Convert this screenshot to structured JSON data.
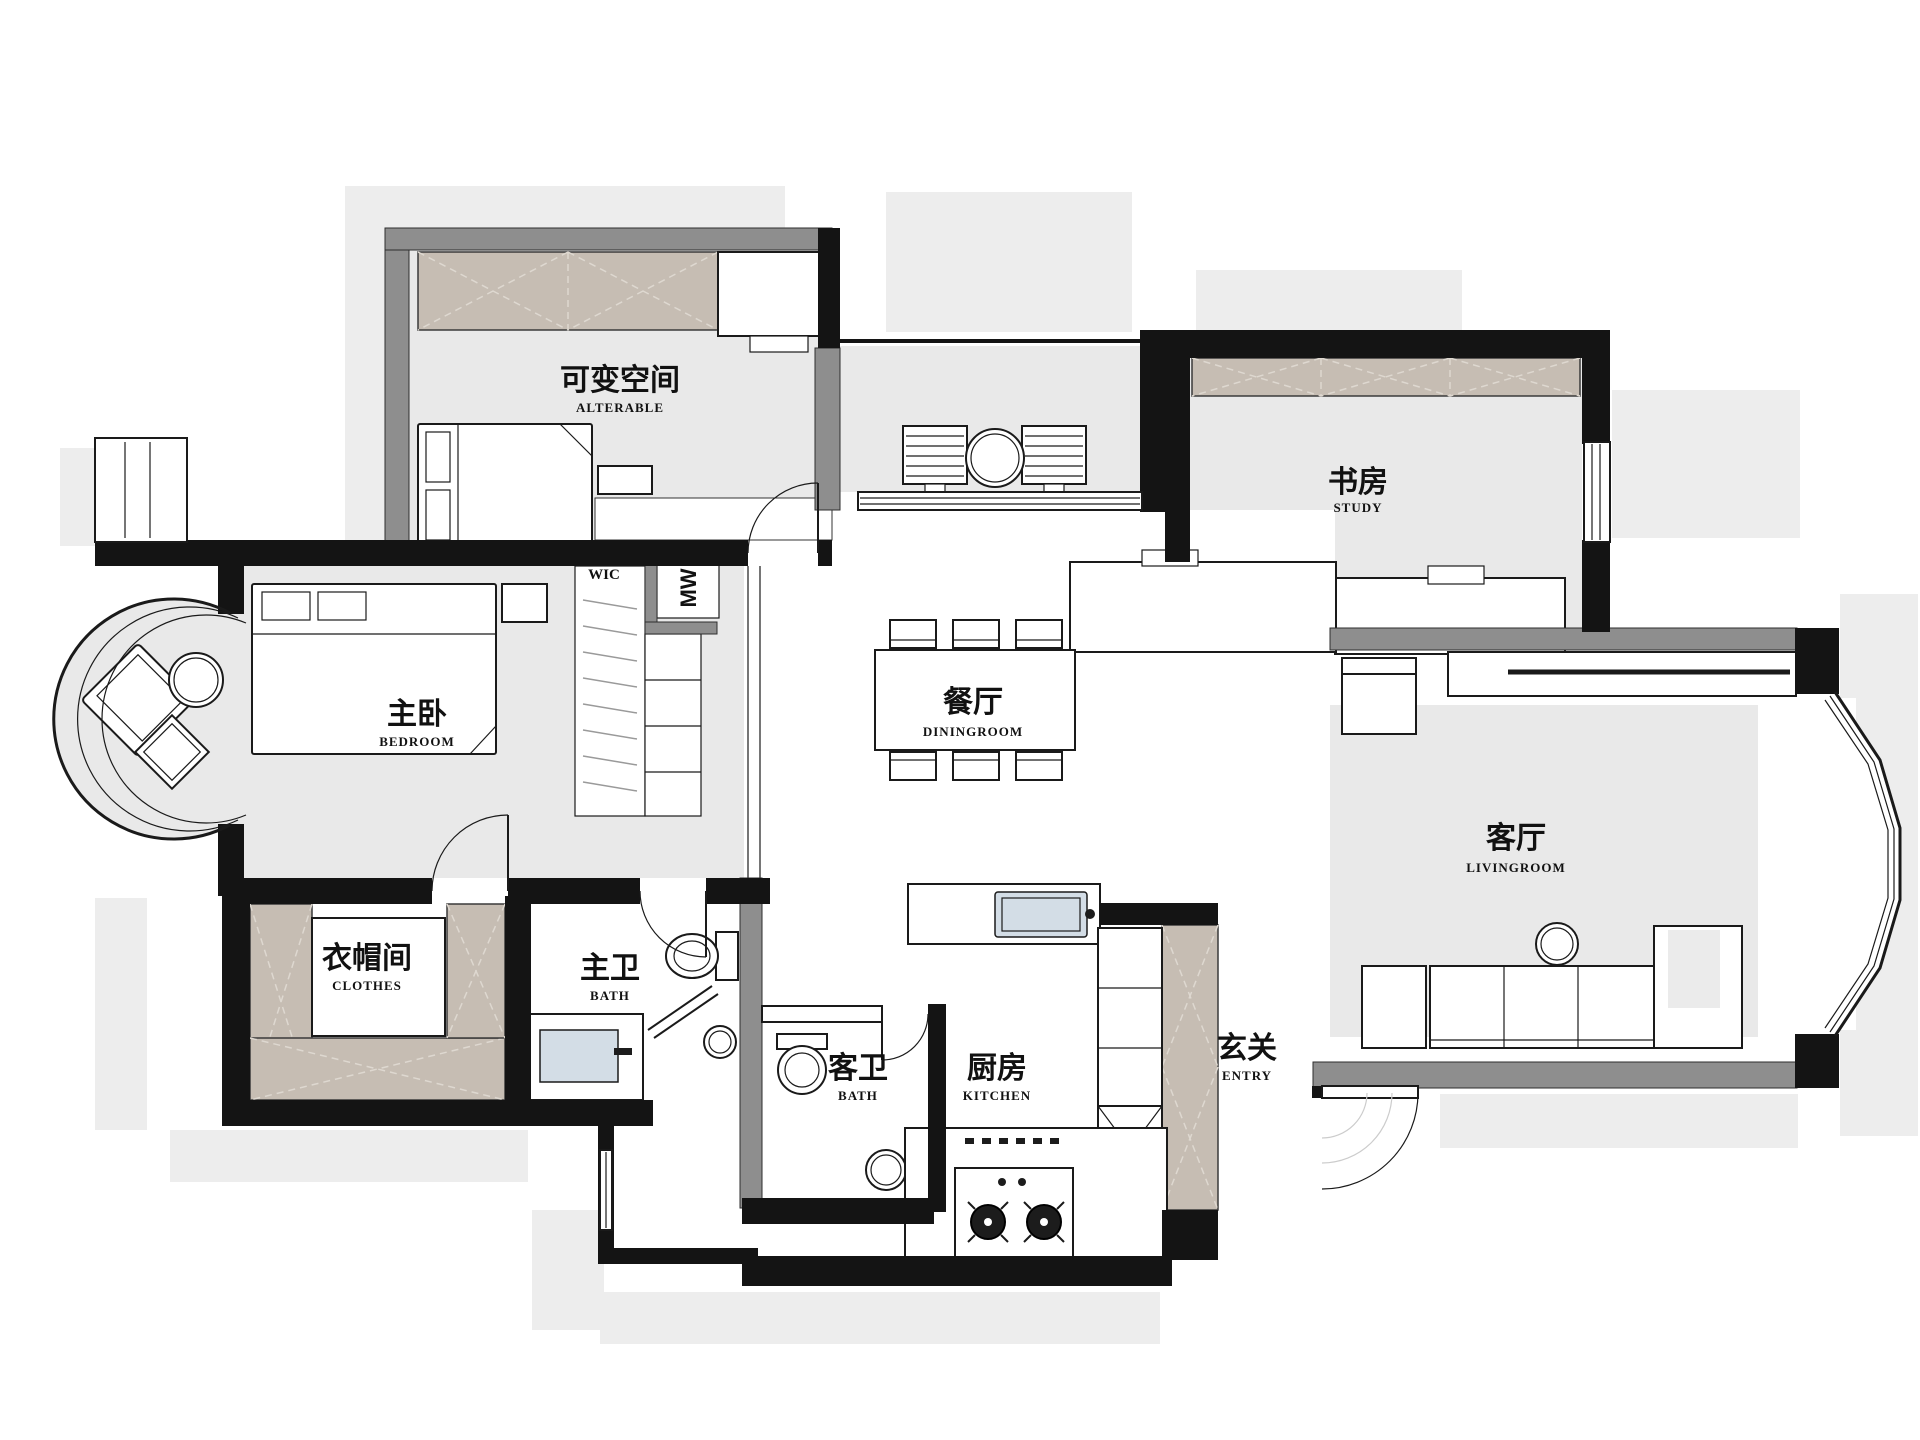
{
  "colors": {
    "wall": "#141414",
    "wall_gray": "#8e8e8e",
    "floor": "#e9e9e9",
    "cabinet": "#c6bdb3",
    "sink": "#d3dde6",
    "shadow": "#ededed"
  },
  "rooms": {
    "alterable": {
      "zh": "可变空间",
      "en": "ALTERABLE"
    },
    "study": {
      "zh": "书房",
      "en": "STUDY"
    },
    "bedroom": {
      "zh": "主卧",
      "en": "BEDROOM"
    },
    "dining": {
      "zh": "餐厅",
      "en": "DININGROOM"
    },
    "living": {
      "zh": "客厅",
      "en": "LIVINGROOM"
    },
    "closet": {
      "zh": "衣帽间",
      "en": "CLOTHES"
    },
    "master_bath": {
      "zh": "主卫",
      "en": "BATH"
    },
    "guest_bath": {
      "zh": "客卫",
      "en": "BATH"
    },
    "kitchen": {
      "zh": "厨房",
      "en": "KITCHEN"
    },
    "entry": {
      "zh": "玄关",
      "en": "ENTRY"
    }
  },
  "annotations": {
    "wic": "WIC",
    "mw": "MW"
  }
}
